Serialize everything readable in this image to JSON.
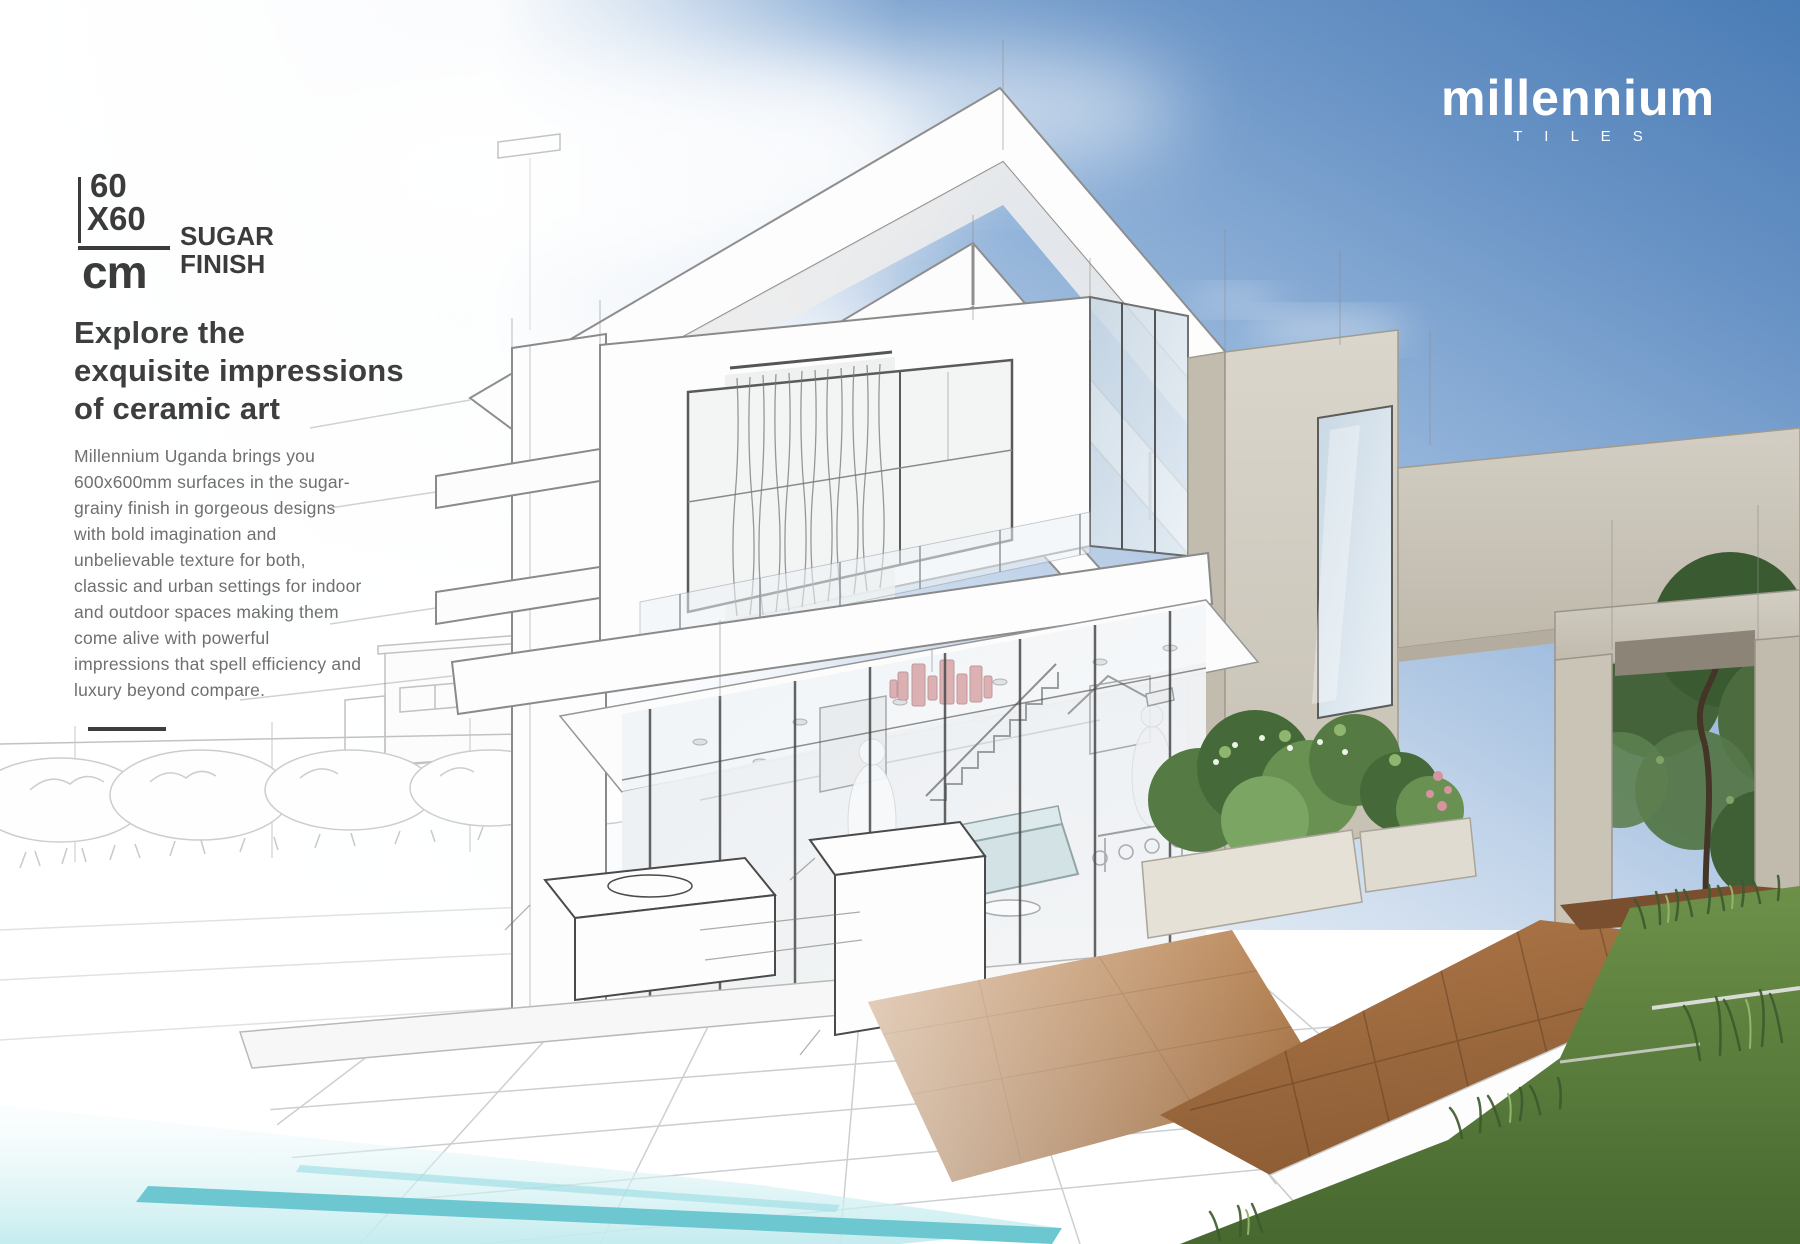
{
  "brand": {
    "name": "millennium",
    "subtitle": "T I L E S"
  },
  "size_badge": {
    "dimension_top": "60",
    "dimension_bottom": "X60",
    "unit": "cm",
    "finish_top": "SUGAR",
    "finish_bottom": "FINISH"
  },
  "headline": {
    "line1": "Explore the",
    "line2": "exquisite impressions",
    "line3": "of ceramic art"
  },
  "intro": {
    "lines": [
      "Millennium Uganda brings you",
      "600x600mm surfaces in the sugar-",
      "grainy finish in gorgeous designs",
      "with bold imagination and",
      "unbelievable texture for both,",
      "classic and urban settings for indoor",
      "and outdoor spaces making them",
      "come alive with powerful",
      "impressions that spell efficiency and",
      "luxury beyond compare."
    ]
  },
  "colors": {
    "heading_text": "#3e3e3e",
    "body_text": "#6f6f6f",
    "badge_text": "#3b3b3b",
    "logo_text": "#ffffff",
    "sky_blue": "#4a7cb5",
    "tile_brown": "#9a6a43",
    "pool_teal": "#6cc7d0",
    "grass_green": "#5d8046",
    "chandelier_pink": "#dda3a3"
  }
}
